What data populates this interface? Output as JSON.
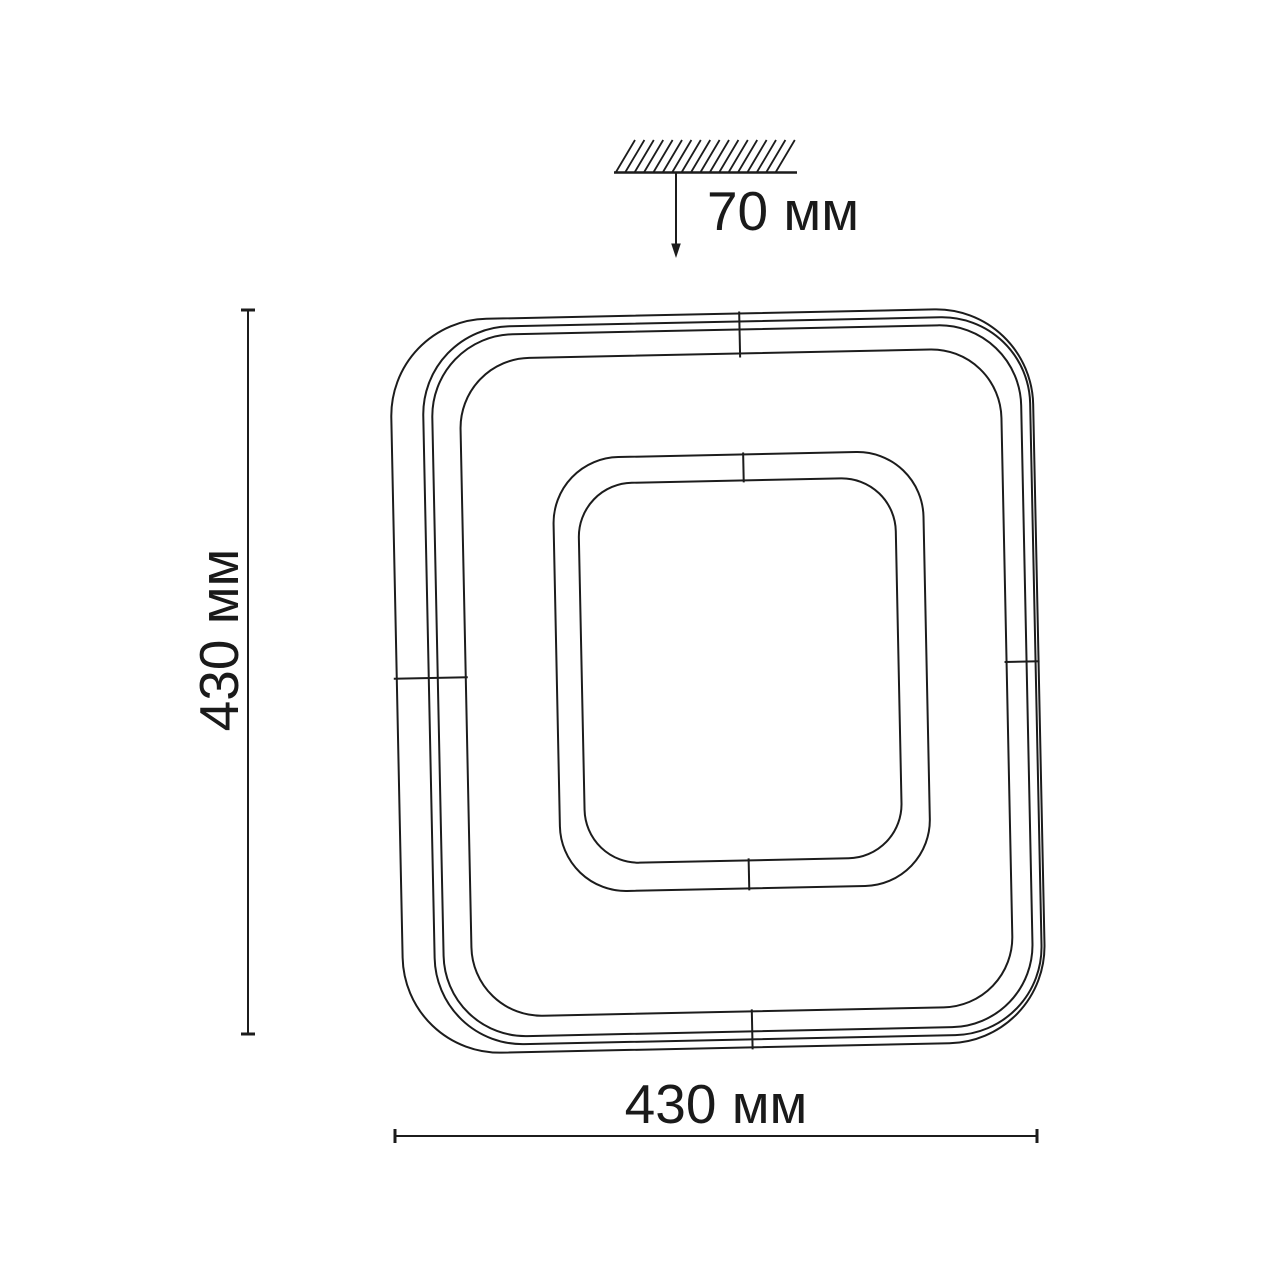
{
  "page": {
    "background": "#ffffff",
    "line_color": "#1c1c1c"
  },
  "diagram": {
    "type": "technical-dimension-drawing",
    "subject": "square ceiling light fixture, front view with ceiling mount offset",
    "labels": {
      "ceiling_offset": "70 мм",
      "height": "430 мм",
      "width": "430 мм"
    }
  }
}
